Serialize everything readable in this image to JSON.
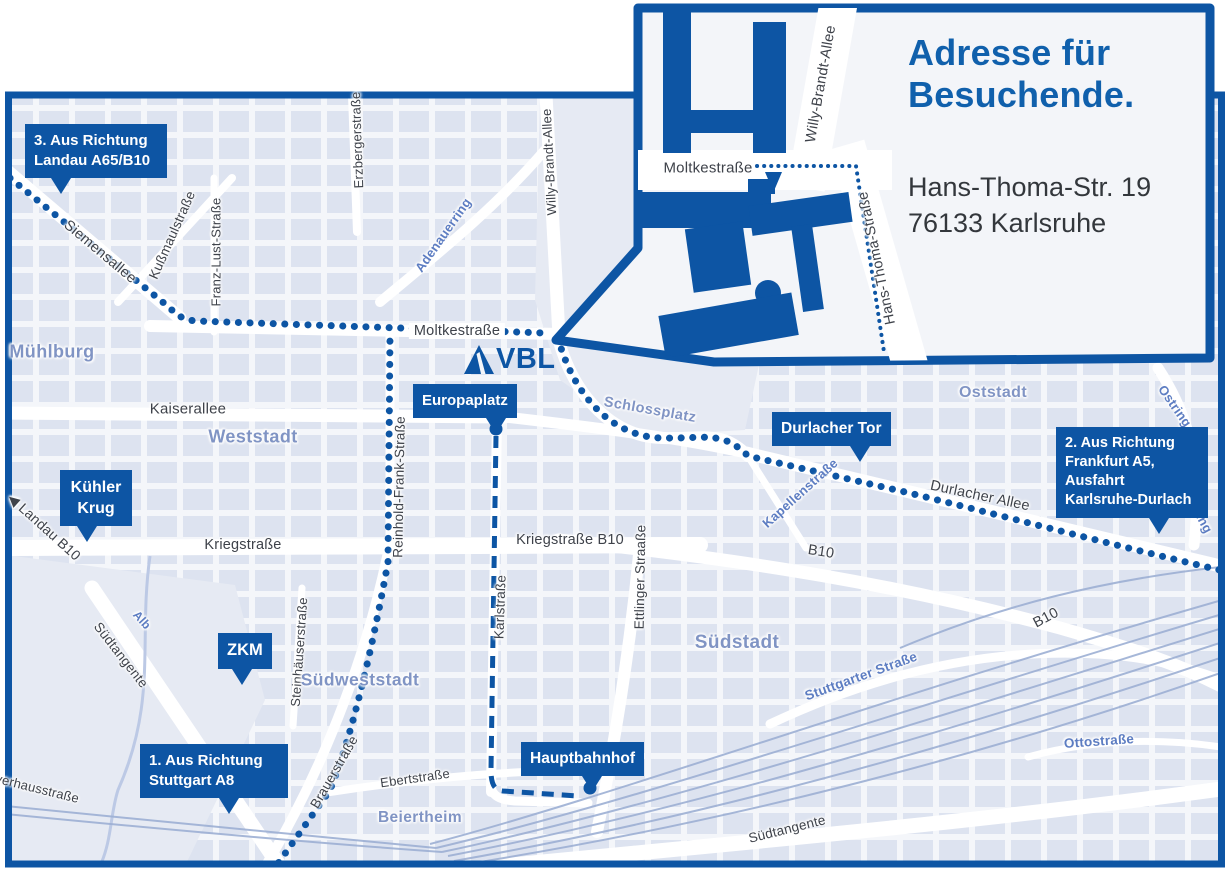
{
  "colors": {
    "primary_blue": "#0d55a4",
    "title_blue": "#1060ac",
    "district_blue": "#8094c4",
    "street_blue": "#5d7dc2",
    "street_text": "#3e424a",
    "map_bg": "#f4f6fa",
    "block_fill": "#dde3f0",
    "park_fill": "#e6eaf3",
    "rail_line": "#9db0d4"
  },
  "inset": {
    "title_line1": "Adresse für",
    "title_line2": "Besuchende.",
    "address_line1": "Hans-Thoma-Str. 19",
    "address_line2": "76133 Karlsruhe"
  },
  "map": {
    "vbl_label": "VBL",
    "callouts": [
      {
        "id": "landau",
        "lines": [
          "3. Aus Richtung",
          "Landau A65/B10"
        ]
      },
      {
        "id": "kuehler-krug",
        "lines": [
          "Kühler",
          "Krug"
        ],
        "kind": "center"
      },
      {
        "id": "zkm",
        "lines": [
          "ZKM"
        ],
        "kind": "center"
      },
      {
        "id": "stuttgart",
        "lines": [
          "1. Aus Richtung",
          "Stuttgart A8"
        ]
      },
      {
        "id": "europaplatz",
        "lines": [
          "Europaplatz"
        ]
      },
      {
        "id": "durlacher-tor",
        "lines": [
          "Durlacher Tor"
        ]
      },
      {
        "id": "hauptbahnhof",
        "lines": [
          "Hauptbahnhof"
        ]
      },
      {
        "id": "frankfurt",
        "lines": [
          "2. Aus Richtung",
          "Frankfurt A5,",
          "Ausfahrt",
          "Karlsruhe-Durlach"
        ]
      }
    ],
    "street_labels": [
      {
        "id": "siemensallee",
        "text": "Siemensallee"
      },
      {
        "id": "kussmaulstrasse",
        "text": "Kußmaulstraße"
      },
      {
        "id": "franz-lust-strasse",
        "text": "Franz-Lust-Straße"
      },
      {
        "id": "erzbergerstrasse",
        "text": "Erzbergerstraße"
      },
      {
        "id": "willy-brandt-allee",
        "text": "Willy-Brandt-Allee"
      },
      {
        "id": "adenauerring",
        "text": "Adenauerring",
        "kind": "blue"
      },
      {
        "id": "moltkestrasse",
        "text": "Moltkestraße",
        "kind": "onroute"
      },
      {
        "id": "muehlburg",
        "text": "Mühlburg",
        "kind": "district"
      },
      {
        "id": "kaiserallee",
        "text": "Kaiserallee"
      },
      {
        "id": "weststadt",
        "text": "Weststadt",
        "kind": "district"
      },
      {
        "id": "reinhold-frank-strasse",
        "text": "Reinhold-Frank-Straße"
      },
      {
        "id": "kriegstrasse",
        "text": "Kriegstraße"
      },
      {
        "id": "kriegstrasse-b10",
        "text": "Kriegstraße B10"
      },
      {
        "id": "karlstrasse",
        "text": "Karlstraße"
      },
      {
        "id": "ettlinger-straasse",
        "text": "Ettlinger Straaße"
      },
      {
        "id": "schlossplatz",
        "text": "Schlossplatz",
        "kind": "district"
      },
      {
        "id": "oststadt",
        "text": "Oststadt",
        "kind": "district"
      },
      {
        "id": "durlacher-allee",
        "text": "Durlacher Allee"
      },
      {
        "id": "kapellenstrasse",
        "text": "Kapellenstraße",
        "kind": "blue"
      },
      {
        "id": "ostring-1",
        "text": "Ostring",
        "kind": "blue"
      },
      {
        "id": "ostring-2",
        "text": "Ostring",
        "kind": "blue"
      },
      {
        "id": "b10-1",
        "text": "B10"
      },
      {
        "id": "b10-2",
        "text": "B10"
      },
      {
        "id": "suedstadt",
        "text": "Südstadt",
        "kind": "district"
      },
      {
        "id": "stuttgarter-strasse",
        "text": "Stuttgarter Straße",
        "kind": "blue"
      },
      {
        "id": "steinhaeuserstrasse",
        "text": "Steinhäuserstraße"
      },
      {
        "id": "suedweststadt",
        "text": "Südweststadt",
        "kind": "district"
      },
      {
        "id": "brauerstrasse",
        "text": "Brauerstraße"
      },
      {
        "id": "ebertstrasse",
        "text": "Ebertstraße"
      },
      {
        "id": "beiertheim",
        "text": "Beiertheim",
        "kind": "district"
      },
      {
        "id": "suedtangente-1",
        "text": "Südtangente"
      },
      {
        "id": "suedtangente-2",
        "text": "Südtangente"
      },
      {
        "id": "alb",
        "text": "Alb",
        "kind": "blue"
      },
      {
        "id": "pulverhausstrasse",
        "text": "Pulverhausstraße"
      },
      {
        "id": "landau-b10",
        "text": "◀ Landau B10"
      },
      {
        "id": "ottostrasse",
        "text": "Ottostraße",
        "kind": "blue"
      },
      {
        "id": "inset-moltkestrasse",
        "text": "Moltkestraße"
      },
      {
        "id": "inset-willy-brandt-allee",
        "text": "Willy-Brandt-Allee"
      },
      {
        "id": "inset-hans-thoma-strasse",
        "text": "Hans-Thoma-Straße"
      }
    ]
  }
}
